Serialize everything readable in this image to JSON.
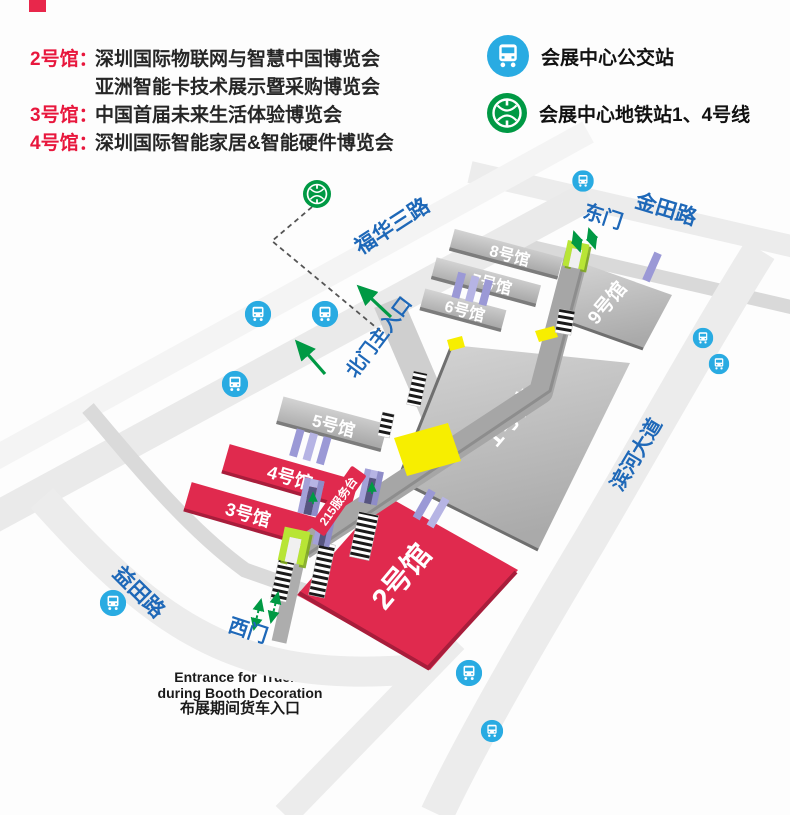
{
  "page": {
    "bg": "#fdfdfd"
  },
  "colors": {
    "accent_red": "#e8173d",
    "hall_red": "#e02a4e",
    "hall_red_edge": "#a81d3b",
    "hall_gray": "#bdbdbd",
    "road_label_blue": "#1e68b8",
    "bus_blue": "#29abe2",
    "metro_green": "#009944",
    "marker_yellow": "#f7ee00",
    "dock_lavender": "#9b99d6",
    "gate_lime": "#b8e535",
    "arrow_green": "#009944"
  },
  "legend_left": {
    "rows": [
      {
        "label": "2号馆：",
        "text": "深圳国际物联网与智慧中国博览会"
      },
      {
        "label": "",
        "text": "亚洲智能卡技术展示暨采购博览会"
      },
      {
        "label": "3号馆：",
        "text": "中国首届未来生活体验博览会"
      },
      {
        "label": "4号馆：",
        "text": "深圳国际智能家居&智能硬件博览会"
      }
    ]
  },
  "legend_right": {
    "bus_label": "会展中心公交站",
    "metro_label": "会展中心地铁站1、4号线"
  },
  "map": {
    "roads": {
      "jintian": "金田路",
      "fuhua": "福华三路",
      "binhe": "滨河大道",
      "yitian": "益田路"
    },
    "gates": {
      "east": "东门",
      "west": "西门",
      "north_main": "北门主入口"
    },
    "halls": {
      "h1": "1号馆",
      "h2": "2号馆",
      "h3": "3号馆",
      "h4": "4号馆",
      "h5": "5号馆",
      "h6": "6号馆",
      "h7": "7号馆",
      "h8": "8号馆",
      "h9": "9号馆"
    },
    "service_desk": "215服务台",
    "truck_entrance": {
      "line1": "Entrance for Trucks",
      "line2": "during Booth Decoration",
      "line3": "布展期间货车入口"
    }
  }
}
